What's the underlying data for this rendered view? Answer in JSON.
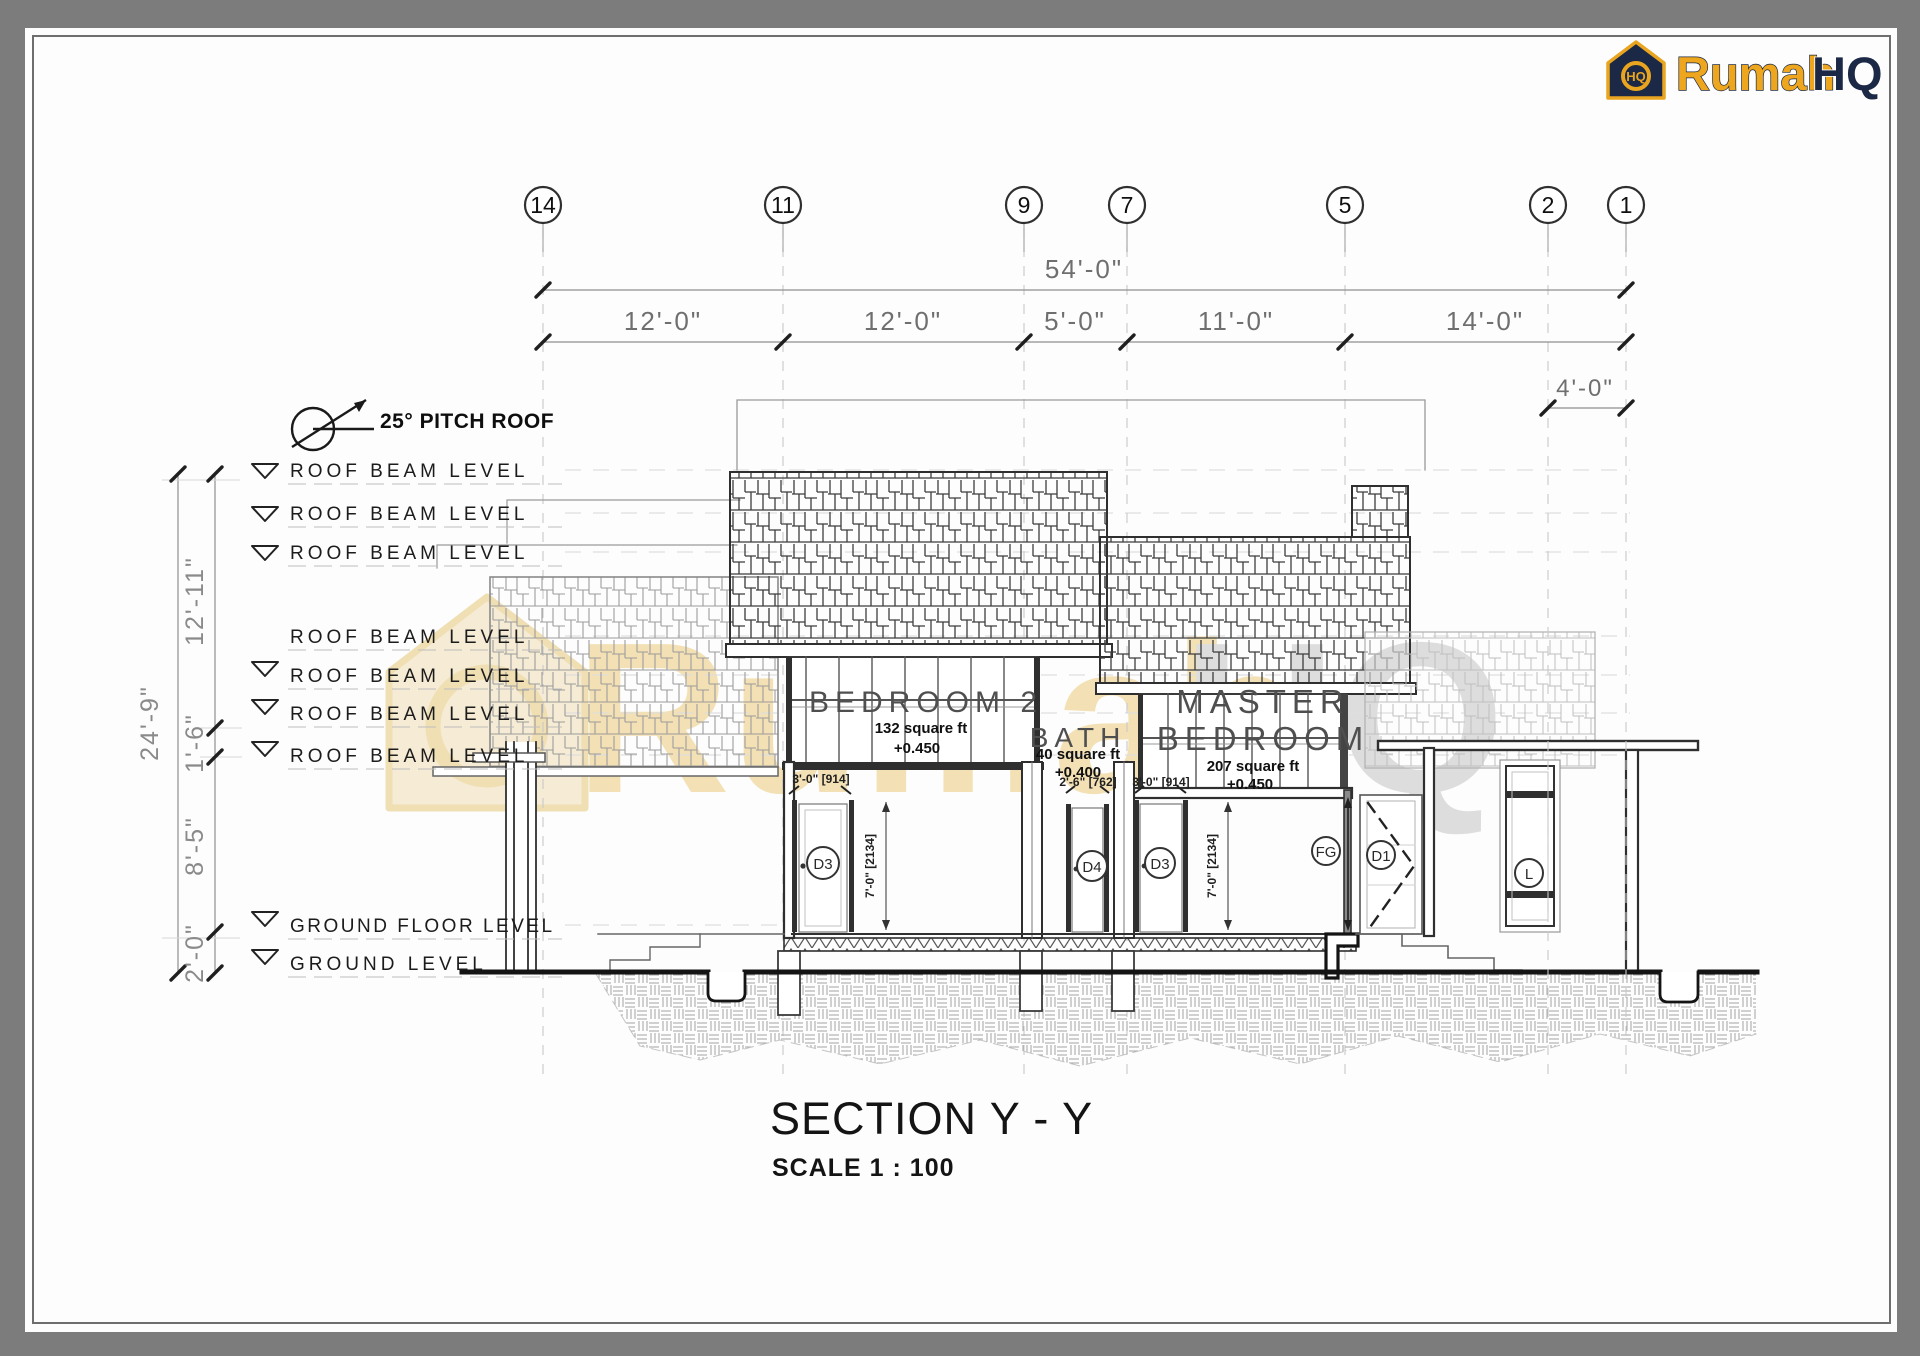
{
  "page": {
    "background": "#7c7c7c",
    "sheet": "#fdfdfd",
    "line_dark": "#2f2f2f"
  },
  "logo": {
    "brand": "Rumah",
    "suffix": "HQ",
    "monogram": "HQ",
    "gold": "#eda61e",
    "navy": "#1b2946"
  },
  "watermark": {
    "brand": "Rumah",
    "suffix": "HQ"
  },
  "grid_bubbles": [
    {
      "label": "14"
    },
    {
      "label": "11"
    },
    {
      "label": "9"
    },
    {
      "label": "7"
    },
    {
      "label": "5"
    },
    {
      "label": "2"
    },
    {
      "label": "1"
    }
  ],
  "dimensions": {
    "overall_width": "54'-0\"",
    "bays": [
      "12'-0\"",
      "12'-0\"",
      "5'-0\"",
      "11'-0\"",
      "14'-0\""
    ],
    "right_offset": "4'-0\"",
    "overall_height": "24'-9\"",
    "height_segments": [
      "12'-11\"",
      "1'-6\"",
      "8'-5\"",
      "2'-0\""
    ]
  },
  "annotations": {
    "pitch": "25° PITCH ROOF",
    "roof_beam_level": "ROOF BEAM LEVEL",
    "ground_floor_level": "GROUND FLOOR LEVEL",
    "ground_level": "GROUND LEVEL"
  },
  "rooms": {
    "bedroom2": {
      "name": "BEDROOM 2",
      "area": "132 square ft",
      "level": "+0.450"
    },
    "bath": {
      "name": "BATH",
      "area": "40 square ft",
      "level": "+0.400"
    },
    "master": {
      "name_line1": "MASTER",
      "name_line2": "BEDROOM",
      "area": "207 square ft",
      "level": "+0.450"
    }
  },
  "door_dims": {
    "d3_width": "3'-0\" [914]",
    "d4_width": "2'-6\" [762]",
    "door_height": "7'-0\" [2134]"
  },
  "tags": {
    "d3": "D3",
    "d4": "D4",
    "fg": "FG",
    "d1": "D1",
    "window": "L"
  },
  "title": {
    "name": "SECTION Y - Y",
    "scale": "SCALE 1 : 100"
  }
}
